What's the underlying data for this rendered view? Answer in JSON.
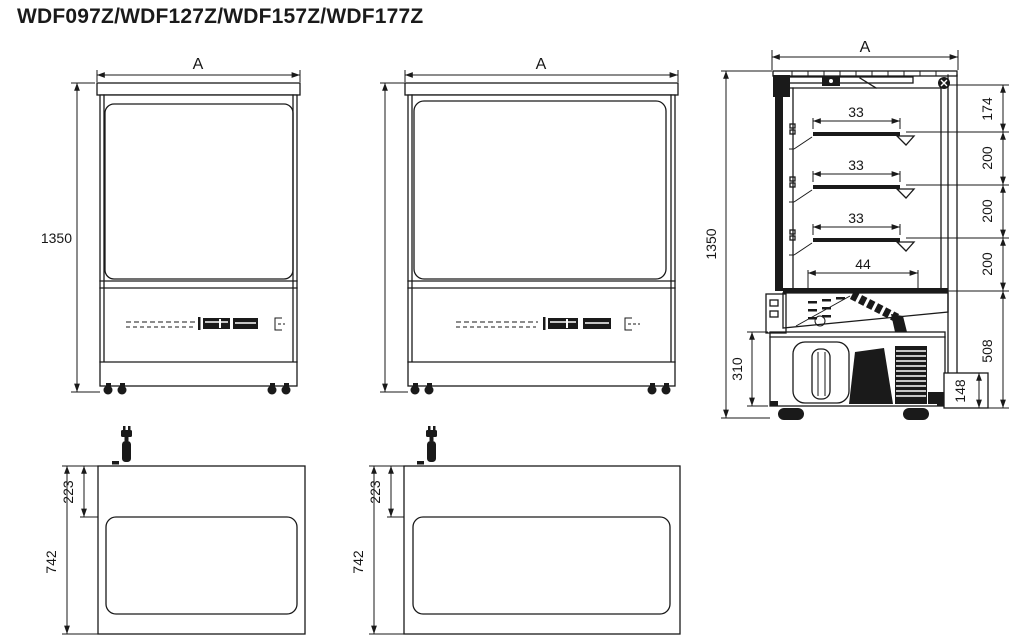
{
  "title": "WDF097Z/WDF127Z/WDF157Z/WDF177Z",
  "colors": {
    "line": "#1a1a1a",
    "background": "#ffffff"
  },
  "views": {
    "front_narrow": {
      "width_label": "A",
      "height_label": "1350"
    },
    "front_wide": {
      "width_label": "A"
    },
    "side": {
      "width_label": "A",
      "height_label": "1350",
      "shelf_depths": [
        "33",
        "33",
        "33"
      ],
      "deck_depth_label": "44",
      "compressor_bay_label": "310",
      "right_stack": [
        "174",
        "200",
        "200",
        "200",
        "508",
        "148"
      ]
    },
    "top_narrow": {
      "depth_label": "742",
      "offset_label": "223"
    },
    "top_wide": {
      "depth_label": "742",
      "offset_label": "223"
    }
  }
}
